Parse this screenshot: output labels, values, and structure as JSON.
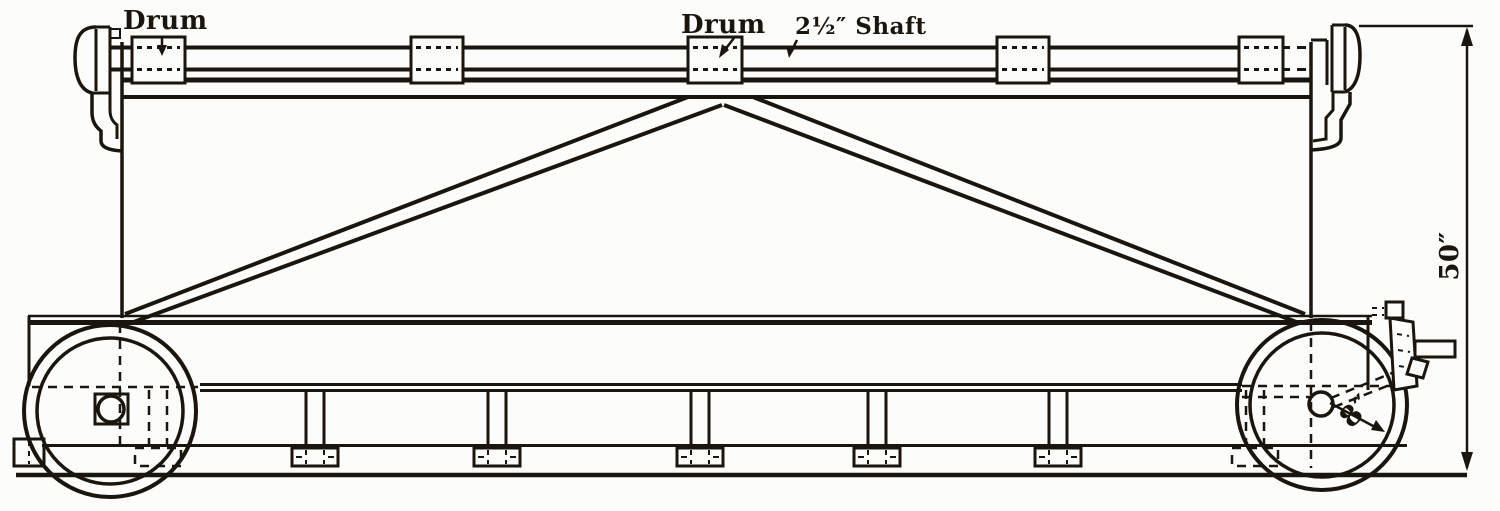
{
  "drawing": {
    "labels": {
      "drum_left": "Drum",
      "drum_center": "Drum",
      "shaft": "2½″ Shaft",
      "height": "50″",
      "hub": "8″"
    },
    "colors": {
      "ink": "#1a150e",
      "paper": "#fcfcfa"
    }
  }
}
